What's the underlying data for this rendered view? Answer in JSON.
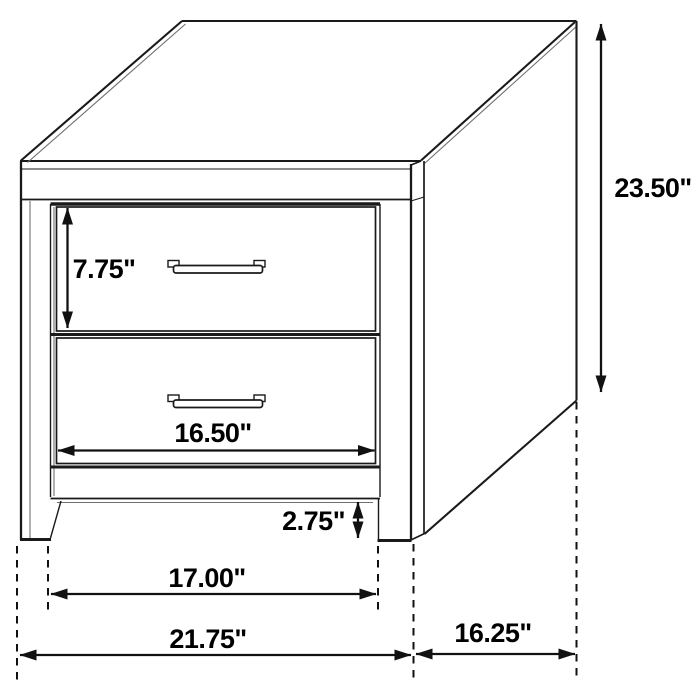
{
  "diagram": {
    "line_color": "#1a1a1a",
    "label_color": "#000000",
    "background_color": "#ffffff",
    "dimensions": {
      "overall_height": "23.50\"",
      "drawer_height": "7.75\"",
      "drawer_width": "16.50\"",
      "base_clearance": "2.75\"",
      "inner_width": "17.00\"",
      "overall_width": "21.75\"",
      "depth": "16.25\""
    }
  }
}
